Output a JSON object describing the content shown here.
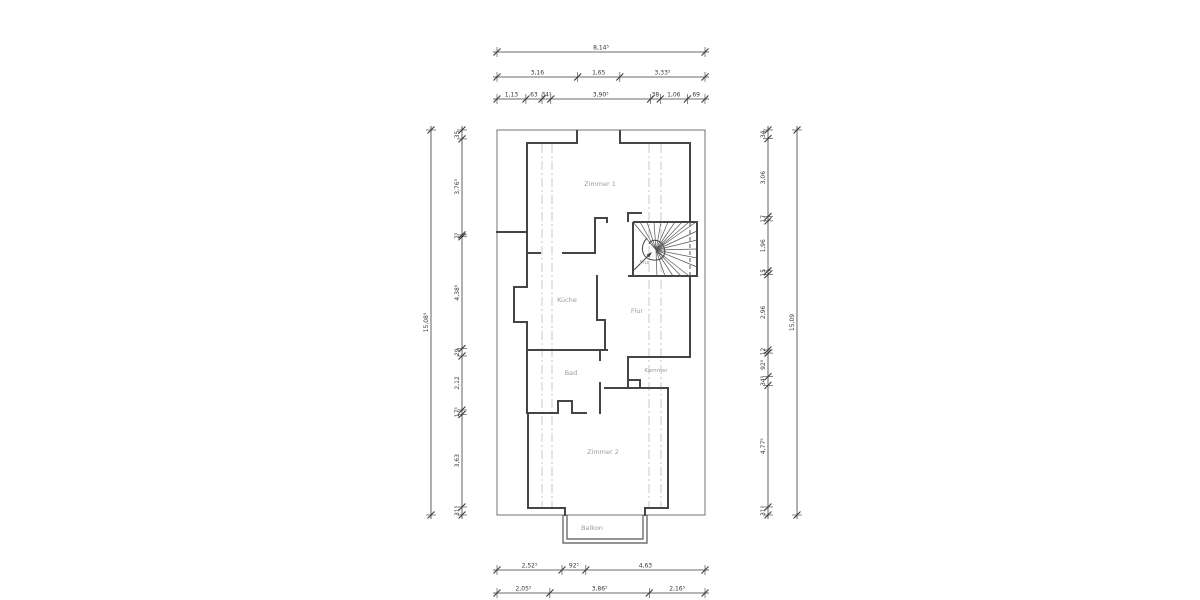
{
  "drawing": {
    "type": "floor-plan",
    "rooms": {
      "zimmer1": {
        "label": "Zimmer 1"
      },
      "flur_stair": {
        "label": "Flur"
      },
      "kueche": {
        "label": "Küche"
      },
      "flur": {
        "label": "Flur"
      },
      "bad": {
        "label": "Bad"
      },
      "kammer": {
        "label": "Kammer"
      },
      "zimmer2": {
        "label": "Zimmer 2"
      },
      "balkon": {
        "label": "Balkon"
      }
    },
    "colors": {
      "wall": "#454545",
      "outer_boundary": "#737373",
      "dimension_line": "#3a3a3a",
      "dimension_text": "#383838",
      "room_label": "#9c9c9c",
      "roof_dashed": "#c9c9c9",
      "background": "#ffffff"
    },
    "dimensions": {
      "top": {
        "rows": [
          {
            "segments": [
              {
                "label": "8,14⁵",
                "value": 8.145
              }
            ]
          },
          {
            "segments": [
              {
                "label": "3,16",
                "value": 3.16
              },
              {
                "label": "1,65",
                "value": 1.65
              },
              {
                "label": "3,33⁵",
                "value": 3.335
              }
            ]
          },
          {
            "segments": [
              {
                "label": "1,13",
                "value": 1.13
              },
              {
                "label": "63",
                "value": 0.63
              },
              {
                "label": "34⁵",
                "value": 0.345
              },
              {
                "label": "3,90⁵",
                "value": 3.905
              },
              {
                "label": "38",
                "value": 0.38
              },
              {
                "label": "1,06",
                "value": 1.06
              },
              {
                "label": "69",
                "value": 0.69
              }
            ]
          }
        ]
      },
      "bottom": {
        "rows": [
          {
            "segments": [
              {
                "label": "2,52⁵",
                "value": 2.525
              },
              {
                "label": "92⁵",
                "value": 0.925
              },
              {
                "label": "4,63",
                "value": 4.63
              }
            ]
          },
          {
            "segments": [
              {
                "label": "2,05⁵",
                "value": 2.055
              },
              {
                "label": "3,86⁵",
                "value": 3.865
              },
              {
                "label": "2,16⁵",
                "value": 2.165
              }
            ]
          }
        ]
      },
      "left": {
        "columns": [
          {
            "segments": [
              {
                "label": "15,08⁵",
                "value": 15.085
              }
            ]
          },
          {
            "segments": [
              {
                "label": "35",
                "value": 0.35
              },
              {
                "label": "3,76⁵",
                "value": 3.765
              },
              {
                "label": "7⁵",
                "value": 0.075
              },
              {
                "label": "4,38⁵",
                "value": 4.385
              },
              {
                "label": "29",
                "value": 0.29
              },
              {
                "label": "2,12",
                "value": 2.12
              },
              {
                "label": "17⁵",
                "value": 0.175
              },
              {
                "label": "3,63",
                "value": 3.63
              },
              {
                "label": "31⁵",
                "value": 0.315
              }
            ]
          }
        ]
      },
      "right": {
        "columns": [
          {
            "segments": [
              {
                "label": "34",
                "value": 0.34
              },
              {
                "label": "3,06",
                "value": 3.06
              },
              {
                "label": "17",
                "value": 0.17
              },
              {
                "label": "1,96",
                "value": 1.96
              },
              {
                "label": "15",
                "value": 0.15
              },
              {
                "label": "2,96",
                "value": 2.96
              },
              {
                "label": "12",
                "value": 0.12
              },
              {
                "label": "92⁵",
                "value": 0.925
              },
              {
                "label": "34⁵",
                "value": 0.345
              },
              {
                "label": "4,77⁵",
                "value": 4.775
              },
              {
                "label": "31⁵",
                "value": 0.315
              }
            ]
          },
          {
            "segments": [
              {
                "label": "15,09",
                "value": 15.09
              }
            ]
          }
        ]
      }
    }
  }
}
